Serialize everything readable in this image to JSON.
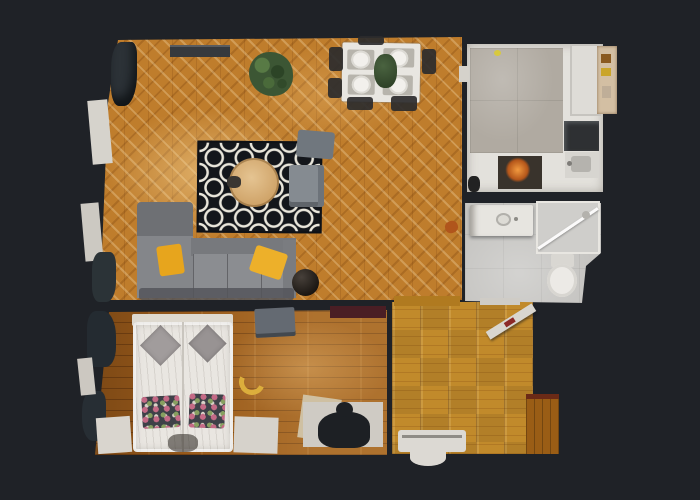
{
  "scene": {
    "label": "Top-down 3D scan floor plan of a one-bedroom apartment",
    "background_color": "#1f2227"
  },
  "palette": {
    "background": "#1f2227",
    "living_parquet": "#bf7d2c",
    "bedroom_planks": "#9a5c1c",
    "hallway_parquet": "#c18a2b",
    "alcove_wood": "#9a5d15",
    "kitchen_tile": "#b0aaa1",
    "bathroom_tile": "#c5c4c1",
    "counter_white": "#e3e1dc",
    "rug_black": "#13161b",
    "rug_pattern_white": "#e9e6db",
    "sofa_gray": "#84868a",
    "pillow_yellow": "#e7a51d",
    "bed_white": "#e9e6e1",
    "plant_green": "#3c5634",
    "oven_glow_orange": "#f29a3f",
    "coffee_table_wood": "#d9b27c"
  },
  "rooms": {
    "living_room": {
      "label": "Living room with herringbone parquet",
      "floor_color": "#bf7d2c"
    },
    "dining_area": {
      "label": "Dining area with set table"
    },
    "kitchen": {
      "label": "Kitchen with gray tile floor and white counters",
      "floor_color": "#b0aaa1"
    },
    "bathroom": {
      "label": "Bathroom with vanity, shower and toilet",
      "floor_color": "#c5c4c1"
    },
    "bedroom": {
      "label": "Bedroom with double bed",
      "floor_color": "#9a5c1c"
    },
    "hallway": {
      "label": "Hallway with square parquet",
      "floor_color": "#c18a2b"
    },
    "alcove": {
      "label": "Entry alcove",
      "floor_color": "#9a5d15"
    }
  },
  "furniture": {
    "dining_table": {
      "label": "White dining table with four place settings",
      "plate_count": 4
    },
    "dining_plant": {
      "label": "Plant centerpiece"
    },
    "rug": {
      "label": "Black and white trellis rug"
    },
    "coffee_table": {
      "label": "Round wooden coffee table"
    },
    "armchair": {
      "label": "Gray armchair"
    },
    "side_chair": {
      "label": "Gray side chair"
    },
    "sofa": {
      "label": "L-shaped gray corner sofa",
      "pillow_count": 2,
      "pillow_color": "#e7a51d"
    },
    "potted_plant": {
      "label": "Potted green plant"
    },
    "curtains": {
      "label": "Dark curtains"
    },
    "window_sill": {
      "label": "White window sill"
    },
    "bed": {
      "label": "Double bed with white duvet",
      "gray_pillows": 2,
      "floral_pillows": 2
    },
    "bench": {
      "label": "Gray bedroom bench"
    },
    "crescent_cushion": {
      "label": "Yellow crescent cushion on floor"
    },
    "clothes_rail": {
      "label": "Dark red rail"
    },
    "cooktop": {
      "label": "Black cooktop"
    },
    "kitchen_sink": {
      "label": "Kitchen sink"
    },
    "oven": {
      "label": "Oven with warm glow"
    },
    "appliance": {
      "label": "White appliance block"
    },
    "shelf": {
      "label": "Beige shelf unit"
    },
    "vanity": {
      "label": "Bathroom vanity with sink"
    },
    "shower": {
      "label": "Glass shower enclosure"
    },
    "toilet": {
      "label": "Toilet"
    },
    "open_door": {
      "label": "Open white door"
    },
    "radiator": {
      "label": "White radiator"
    },
    "bag": {
      "label": "Dark bag on floor"
    },
    "floor_rug_white": {
      "label": "Small white rug"
    },
    "scan_shadow": {
      "label": "Scan shadow silhouette"
    }
  }
}
